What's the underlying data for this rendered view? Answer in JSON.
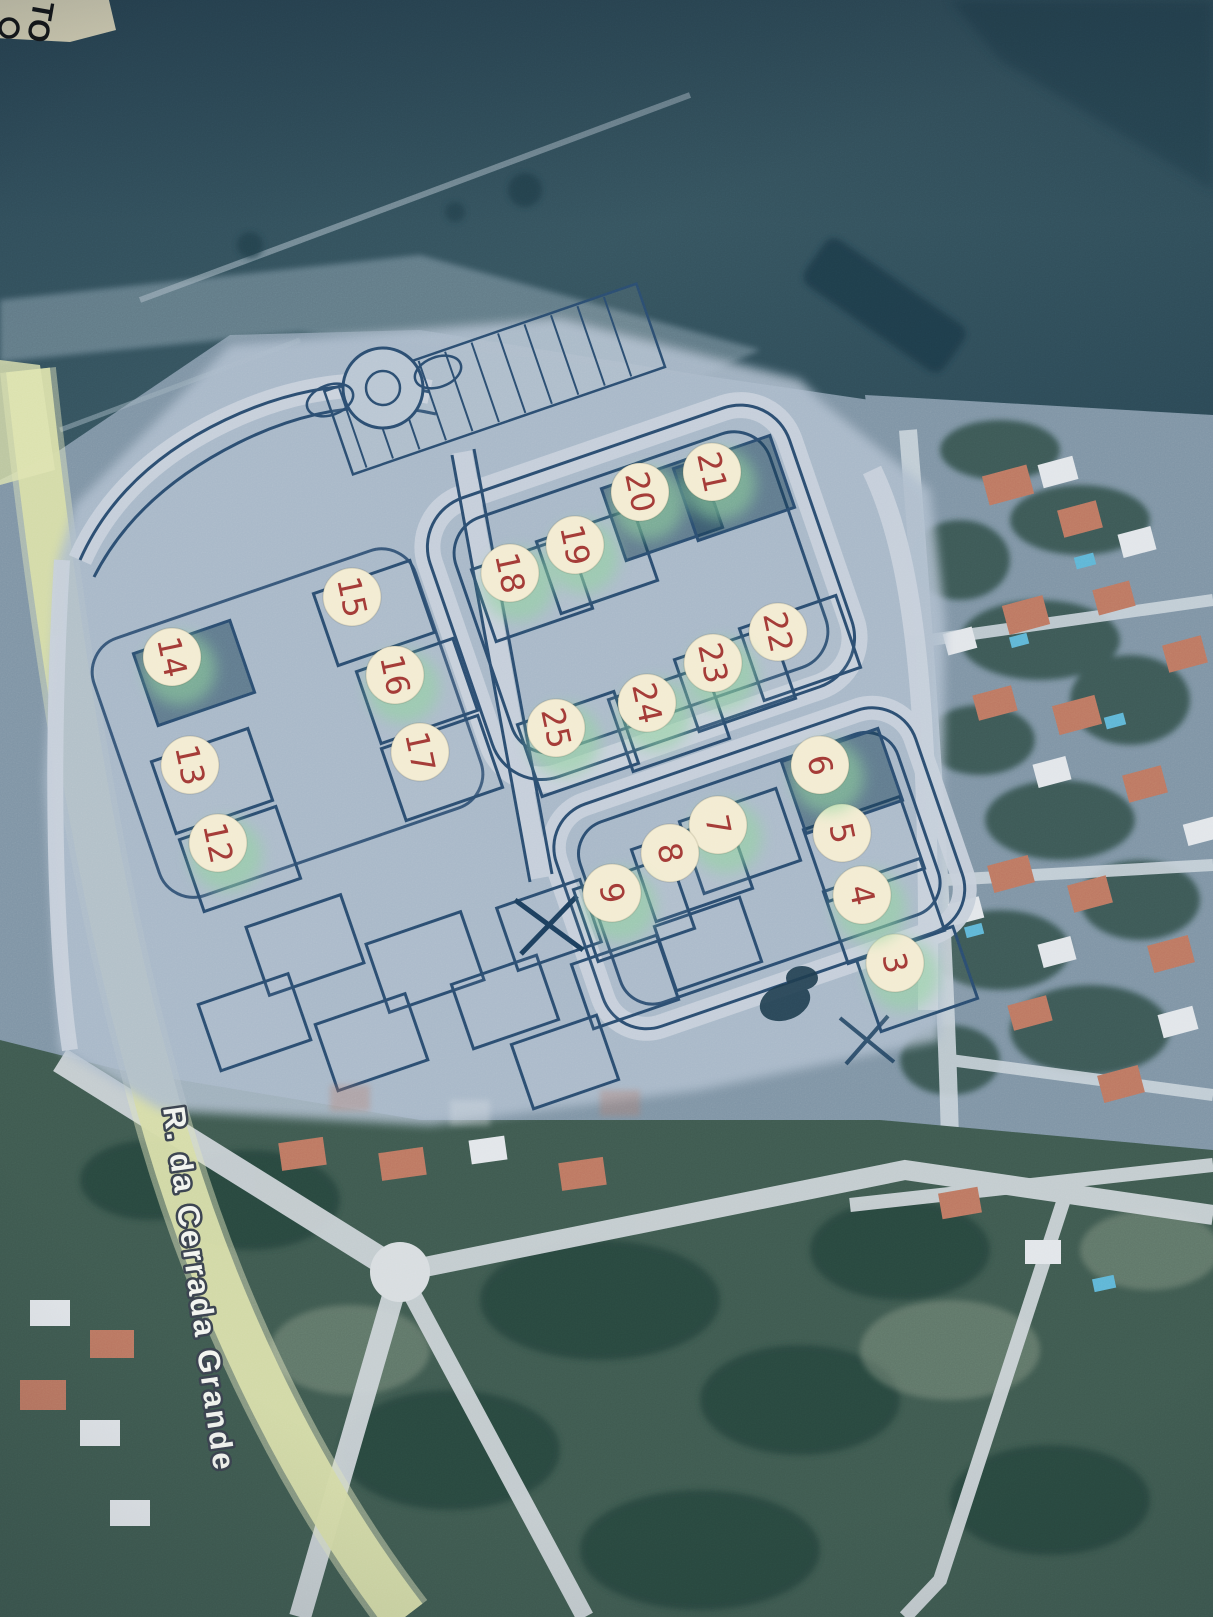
{
  "photo": {
    "corner_label": "TO",
    "street_label": "R. da Cerrada Grande"
  },
  "markers": {
    "fill": "#f3ecd2",
    "number_color": "#a23a36",
    "glow_color": "#8fd49c",
    "rotation_deg": 78,
    "items": [
      {
        "n": "3",
        "x": 895,
        "y": 963,
        "glow": true,
        "dark": false
      },
      {
        "n": "4",
        "x": 862,
        "y": 895,
        "glow": true,
        "dark": false
      },
      {
        "n": "5",
        "x": 842,
        "y": 833,
        "glow": false,
        "dark": false
      },
      {
        "n": "6",
        "x": 820,
        "y": 765,
        "glow": true,
        "dark": true
      },
      {
        "n": "7",
        "x": 718,
        "y": 825,
        "glow": true,
        "dark": false
      },
      {
        "n": "8",
        "x": 670,
        "y": 853,
        "glow": false,
        "dark": false
      },
      {
        "n": "9",
        "x": 612,
        "y": 893,
        "glow": true,
        "dark": false
      },
      {
        "n": "12",
        "x": 218,
        "y": 843,
        "glow": true,
        "dark": false
      },
      {
        "n": "13",
        "x": 190,
        "y": 765,
        "glow": false,
        "dark": false
      },
      {
        "n": "14",
        "x": 172,
        "y": 657,
        "glow": true,
        "dark": true
      },
      {
        "n": "15",
        "x": 352,
        "y": 597,
        "glow": false,
        "dark": false
      },
      {
        "n": "16",
        "x": 395,
        "y": 675,
        "glow": true,
        "dark": false
      },
      {
        "n": "17",
        "x": 420,
        "y": 752,
        "glow": false,
        "dark": false
      },
      {
        "n": "18",
        "x": 510,
        "y": 573,
        "glow": true,
        "dark": false
      },
      {
        "n": "19",
        "x": 575,
        "y": 545,
        "glow": true,
        "dark": false
      },
      {
        "n": "20",
        "x": 640,
        "y": 492,
        "glow": true,
        "dark": true
      },
      {
        "n": "21",
        "x": 712,
        "y": 472,
        "glow": true,
        "dark": true
      },
      {
        "n": "22",
        "x": 778,
        "y": 632,
        "glow": false,
        "dark": false
      },
      {
        "n": "23",
        "x": 713,
        "y": 663,
        "glow": true,
        "dark": false
      },
      {
        "n": "24",
        "x": 647,
        "y": 703,
        "glow": true,
        "dark": false
      },
      {
        "n": "25",
        "x": 556,
        "y": 728,
        "glow": true,
        "dark": false
      }
    ]
  },
  "palette": {
    "satellite_base": "#7f94a5",
    "field_dark": "#304d5c",
    "plan_overlay": "#aebdcd",
    "plan_line": "#2b4d70",
    "lot_dark_fill": "rgba(26,62,84,0.5)",
    "road_light": "#cdd5da",
    "road_plan_light": "#c7d0db",
    "road_yellow": "#d6dca8",
    "roof_orange": "#bd7862",
    "roof_white": "#e2e6ea",
    "vegetation_dark": "#31504a",
    "pool_blue": "#5fb6d6",
    "corner_label_fill": "#efe7c6",
    "street_label_text": "#f2f4ef",
    "street_label_outline": "#3a424e"
  }
}
